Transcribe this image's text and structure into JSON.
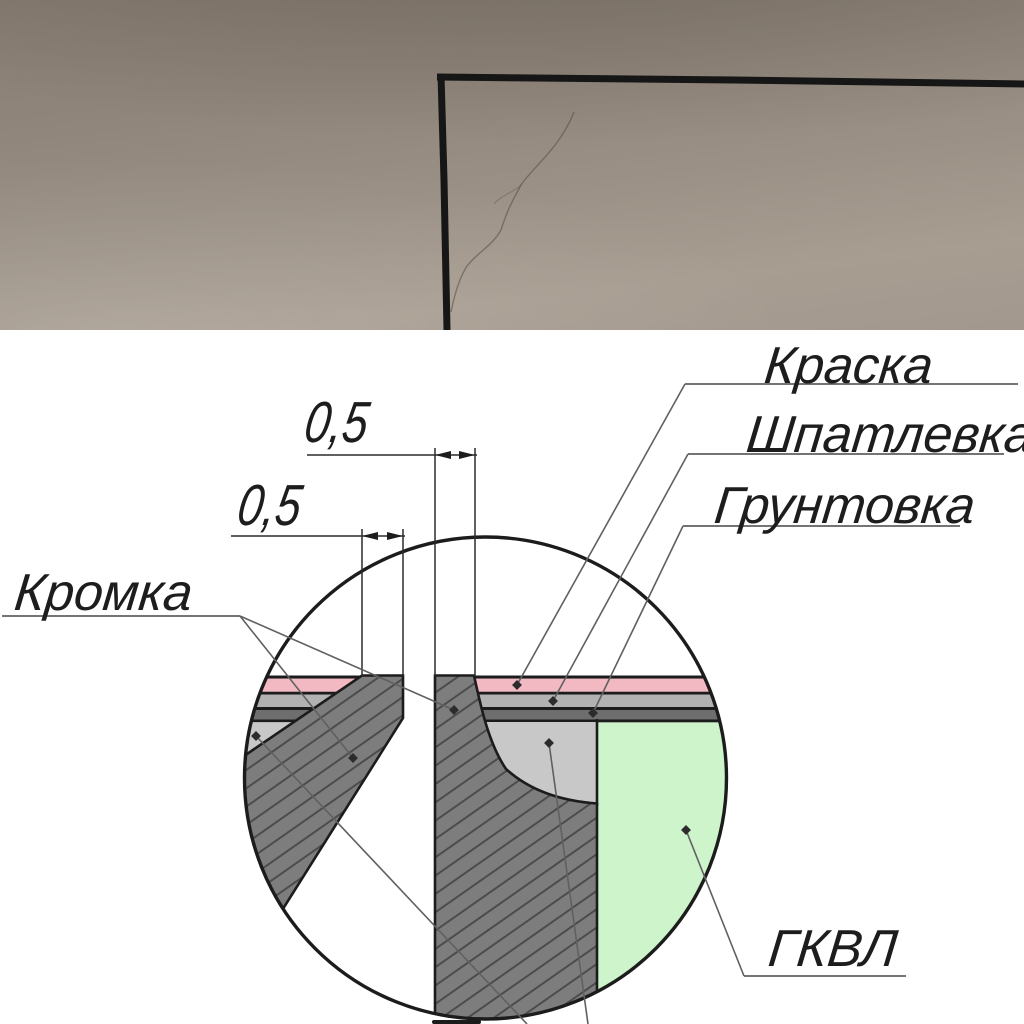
{
  "title": "Drywall joint finishing detail (GKVL seam) over wall crack photo",
  "labels": {
    "paint": "Краска",
    "putty": "Шпатлевка",
    "primer": "Грунтовка",
    "edge": "Кромка",
    "board": "ГКВЛ"
  },
  "dimensions": {
    "edge_width_right": "0,5",
    "edge_width_left": "0,5"
  },
  "colors": {
    "paint_layer": "#f3b9c3",
    "putty_layer": "#b2b2b2",
    "primer_layer": "#6e6e6e",
    "board_fill": "#cdf4cb",
    "filler_fill": "#c8c8c8",
    "section_fill": "#7d7d7d",
    "hatch_line": "#4c4c4c",
    "outline": "#1c1c1c",
    "leader": "#606060",
    "wall_photo_top": "#877d73",
    "wall_photo_bottom": "#a89d91",
    "marker_line": "#151515"
  }
}
